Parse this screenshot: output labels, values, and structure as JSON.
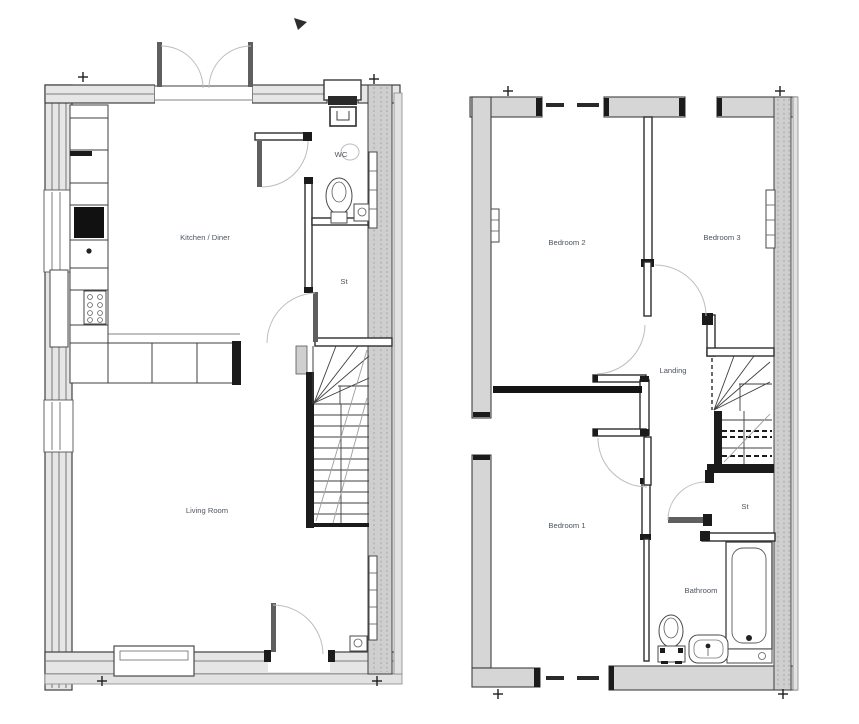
{
  "plans": {
    "ground_floor": {
      "kitchen_diner": "Kitchen / Diner",
      "wc": "WC",
      "store": "St",
      "living_room": "Living Room"
    },
    "first_floor": {
      "bedroom2": "Bedroom 2",
      "bedroom3": "Bedroom 3",
      "landing": "Landing",
      "bedroom1": "Bedroom 1",
      "store": "St",
      "bathroom": "Bathroom"
    }
  },
  "colors": {
    "background": "#ffffff",
    "line": "#3f3f3f",
    "external_wall_fill": "#e6e6e6",
    "party_wall_fill": "#cfcfcf",
    "label_text": "#4e5560"
  }
}
